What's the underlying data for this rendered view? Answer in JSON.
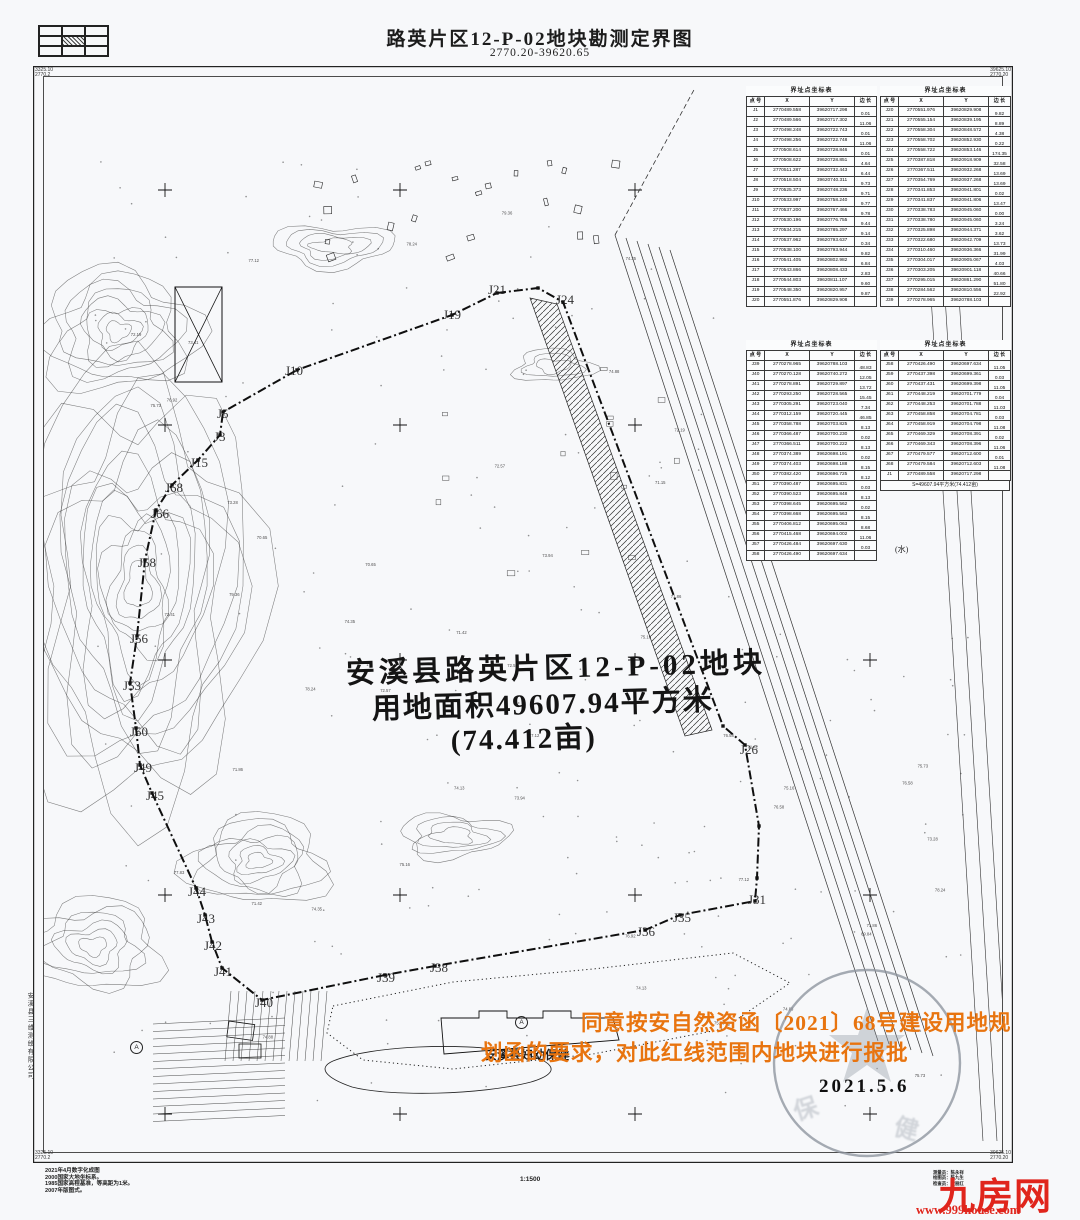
{
  "header": {
    "title": "路英片区12-P-02地块勘测定界图",
    "sheet_no": "2770.20-39620.65"
  },
  "corner_labels": {
    "top_left": [
      "3325.10",
      "2770.2"
    ],
    "top_right": [
      "39625.10",
      "2770.20"
    ],
    "bottom_left": [
      "3325.10",
      "2770.2"
    ],
    "bottom_right": [
      "39625.10",
      "2770.20"
    ]
  },
  "tables": {
    "title": "界址点坐标表",
    "columns": [
      "点 号",
      "X",
      "Y",
      "边 长"
    ],
    "summary": "S=49607.94平方米(74.412亩)",
    "blocks": [
      {
        "rows": [
          [
            "J1",
            "2770489.558",
            "39620717.298",
            "0.01"
          ],
          [
            "J2",
            "2770489.566",
            "39620717.302",
            "11.06"
          ],
          [
            "J3",
            "2770498.248",
            "39620722.743",
            "0.01"
          ],
          [
            "J4",
            "2770498.256",
            "39620722.748",
            "11.06"
          ],
          [
            "J5",
            "2770508.614",
            "39620728.846",
            "0.01"
          ],
          [
            "J6",
            "2770508.622",
            "39620728.851",
            "4.64"
          ],
          [
            "J7",
            "2770511.287",
            "39620732.443",
            "6.44"
          ],
          [
            "J8",
            "2770518.504",
            "39620740.311",
            "9.73"
          ],
          [
            "J9",
            "2770525.373",
            "39620748.236",
            "9.71"
          ],
          [
            "J10",
            "2770533.997",
            "39620758.240",
            "9.77"
          ],
          [
            "J11",
            "2770537.200",
            "39620767.466",
            "9.78"
          ],
          [
            "J12",
            "2770530.196",
            "39620776.755",
            "9.44"
          ],
          [
            "J13",
            "2770534.215",
            "39620785.297",
            "9.14"
          ],
          [
            "J14",
            "2770537.962",
            "39620793.637",
            "0.34"
          ],
          [
            "J15",
            "2770538.100",
            "39620793.944",
            "9.82"
          ],
          [
            "J16",
            "2770541.405",
            "39620802.982",
            "6.84"
          ],
          [
            "J17",
            "2770543.866",
            "39620808.433",
            "2.83"
          ],
          [
            "J18",
            "2770544.803",
            "39620811.107",
            "9.60"
          ],
          [
            "J19",
            "2770548.350",
            "39620820.957",
            "9.87"
          ],
          [
            "J20",
            "2770551.876",
            "39620829.908",
            ""
          ]
        ]
      },
      {
        "rows": [
          [
            "J20",
            "2770551.976",
            "39620829.908",
            "9.82"
          ],
          [
            "J21",
            "2770555.154",
            "39620839.195",
            "8.89"
          ],
          [
            "J22",
            "2770558.304",
            "39620848.572",
            "4.38"
          ],
          [
            "J23",
            "2770558.702",
            "39620852.930",
            "0.22"
          ],
          [
            "J24",
            "2770558.722",
            "39620853.146",
            "174.35"
          ],
          [
            "J25",
            "2770387.818",
            "39620918.909",
            "32.58"
          ],
          [
            "J26",
            "2770367.511",
            "39620932.268",
            "13.69"
          ],
          [
            "J27",
            "2770354.769",
            "39620937.268",
            "13.69"
          ],
          [
            "J28",
            "2770341.853",
            "39620941.801",
            "0.02"
          ],
          [
            "J29",
            "2770341.837",
            "39620941.806",
            "13.47"
          ],
          [
            "J30",
            "2770338.783",
            "39620945.060",
            "0.00"
          ],
          [
            "J31",
            "2770338.780",
            "39620945.060",
            "3.24"
          ],
          [
            "J32",
            "2770325.898",
            "39620944.371",
            "3.62"
          ],
          [
            "J33",
            "2770322.680",
            "39620942.709",
            "13.73"
          ],
          [
            "J34",
            "2770310.460",
            "39620936.366",
            "31.99"
          ],
          [
            "J35",
            "2770304.017",
            "39620905.067",
            "4.03"
          ],
          [
            "J36",
            "2770303.205",
            "39620901.118",
            "40.66"
          ],
          [
            "J37",
            "2770295.015",
            "39620861.290",
            "51.80"
          ],
          [
            "J38",
            "2770284.562",
            "39620810.556",
            "22.92"
          ],
          [
            "J39",
            "2770278.965",
            "39620788.103",
            ""
          ]
        ]
      },
      {
        "rows": [
          [
            "J39",
            "2770278.965",
            "39620788.103",
            "48.83"
          ],
          [
            "J40",
            "2770270.128",
            "39620740.272",
            "12.05"
          ],
          [
            "J41",
            "2770278.891",
            "39620729.897",
            "13.72"
          ],
          [
            "J42",
            "2770293.250",
            "39620728.565",
            "15.45"
          ],
          [
            "J43",
            "2770305.291",
            "39620723.040",
            "7.34"
          ],
          [
            "J44",
            "2770312.159",
            "39620720.445",
            "46.85"
          ],
          [
            "J45",
            "2770358.788",
            "39620703.825",
            "8.13"
          ],
          [
            "J46",
            "2770366.487",
            "39620700.230",
            "0.02"
          ],
          [
            "J47",
            "2770366.511",
            "39620700.222",
            "8.13"
          ],
          [
            "J48",
            "2770374.389",
            "39620698.191",
            "0.02"
          ],
          [
            "J49",
            "2770374.403",
            "39620698.188",
            "8.15"
          ],
          [
            "J50",
            "2770382.420",
            "39620696.725",
            "8.12"
          ],
          [
            "J51",
            "2770390.487",
            "39620695.831",
            "0.03"
          ],
          [
            "J52",
            "2770390.523",
            "39620695.848",
            "8.13"
          ],
          [
            "J53",
            "2770398.645",
            "39620695.562",
            "0.02"
          ],
          [
            "J54",
            "2770398.668",
            "39620695.563",
            "8.15"
          ],
          [
            "J55",
            "2770406.812",
            "39620695.063",
            "8.68"
          ],
          [
            "J56",
            "2770415.468",
            "39620694.002",
            "11.06"
          ],
          [
            "J57",
            "2770426.484",
            "39620697.630",
            "0.03"
          ],
          [
            "J58",
            "2770426.490",
            "39620697.634",
            ""
          ]
        ]
      },
      {
        "rows": [
          [
            "J58",
            "2770426.490",
            "39620697.634",
            "11.05"
          ],
          [
            "J59",
            "2770437.398",
            "39620699.361",
            "0.03"
          ],
          [
            "J60",
            "2770437.431",
            "39620699.398",
            "11.05"
          ],
          [
            "J61",
            "2770448.219",
            "39620701.779",
            "0.04"
          ],
          [
            "J62",
            "2770448.253",
            "39620701.788",
            "11.03"
          ],
          [
            "J63",
            "2770458.858",
            "39620704.781",
            "0.03"
          ],
          [
            "J64",
            "2770458.919",
            "39620704.798",
            "11.08"
          ],
          [
            "J65",
            "2770469.329",
            "39620708.391",
            "0.02"
          ],
          [
            "J66",
            "2770469.343",
            "39620708.396",
            "11.06"
          ],
          [
            "J67",
            "2770479.577",
            "39620712.600",
            "0.01"
          ],
          [
            "J68",
            "2770479.584",
            "39620712.603",
            "11.08"
          ],
          [
            "J1",
            "2770489.558",
            "39620717.298",
            ""
          ]
        ]
      }
    ]
  },
  "map": {
    "parcel_text": [
      "安溪县路英片区12-P-02地块",
      "用地面积49607.94平方米",
      "(74.412亩)"
    ],
    "approval_line1": "同意按安自然资函〔2021〕68号建设用地规",
    "approval_line2": "划函的要求，对此红线范围内地块进行报批",
    "clinic_label": "安溪县妇幼保健",
    "stamp_date": "2021.5.6",
    "point_labels": [
      {
        "t": "J21",
        "x": 455,
        "y": 216
      },
      {
        "t": "J24",
        "x": 523,
        "y": 226
      },
      {
        "t": "J19",
        "x": 410,
        "y": 241
      },
      {
        "t": "J10",
        "x": 252,
        "y": 297
      },
      {
        "t": "J5",
        "x": 184,
        "y": 340
      },
      {
        "t": "J3",
        "x": 181,
        "y": 363
      },
      {
        "t": "J15",
        "x": 157,
        "y": 389
      },
      {
        "t": "J68",
        "x": 132,
        "y": 414
      },
      {
        "t": "J66",
        "x": 118,
        "y": 440
      },
      {
        "t": "J58",
        "x": 105,
        "y": 489
      },
      {
        "t": "J56",
        "x": 97,
        "y": 565
      },
      {
        "t": "J53",
        "x": 90,
        "y": 612
      },
      {
        "t": "J50",
        "x": 97,
        "y": 658
      },
      {
        "t": "J49",
        "x": 101,
        "y": 694
      },
      {
        "t": "J45",
        "x": 113,
        "y": 722
      },
      {
        "t": "J44",
        "x": 155,
        "y": 818
      },
      {
        "t": "J43",
        "x": 164,
        "y": 845
      },
      {
        "t": "J42",
        "x": 171,
        "y": 872
      },
      {
        "t": "J41",
        "x": 181,
        "y": 898
      },
      {
        "t": "J40",
        "x": 222,
        "y": 929
      },
      {
        "t": "J39",
        "x": 344,
        "y": 904
      },
      {
        "t": "J38",
        "x": 397,
        "y": 894
      },
      {
        "t": "J36",
        "x": 604,
        "y": 858
      },
      {
        "t": "J35",
        "x": 640,
        "y": 844
      },
      {
        "t": "J31",
        "x": 715,
        "y": 826
      },
      {
        "t": "J26",
        "x": 707,
        "y": 676
      }
    ],
    "water_labels": [
      {
        "t": "(水)",
        "x": 868,
        "y": 368
      },
      {
        "t": "(水)",
        "x": 862,
        "y": 478
      }
    ],
    "spot_elevations": [
      "74.35",
      "73.28",
      "75.16",
      "71.42",
      "76.58",
      "72.19",
      "74.88",
      "70.65",
      "77.12",
      "73.94",
      "75.73",
      "71.86",
      "78.24",
      "72.57",
      "74.13",
      "76.92",
      "73.41",
      "75.58",
      "77.83",
      "71.15",
      "69.84",
      "79.36"
    ]
  },
  "footer": {
    "notes": [
      "2021年4月数字化成图",
      "2000国家大地坐标系。",
      "1985国家高程基准，等高距为1米。",
      "2007年版图式。"
    ],
    "scale": "1:1500",
    "staff": [
      "测量员：陈永祥",
      "绘图员：陈九生",
      "检查员：黄丽红"
    ],
    "logo": "九房网",
    "website": "www.999house.com",
    "company_vertical": "安溪县三维测绘有限公司"
  },
  "colors": {
    "approval_orange": "#e8740f",
    "logo_red": "#e0251c",
    "stamp_gray": "#8d949e",
    "ink": "#1c1c1c"
  }
}
